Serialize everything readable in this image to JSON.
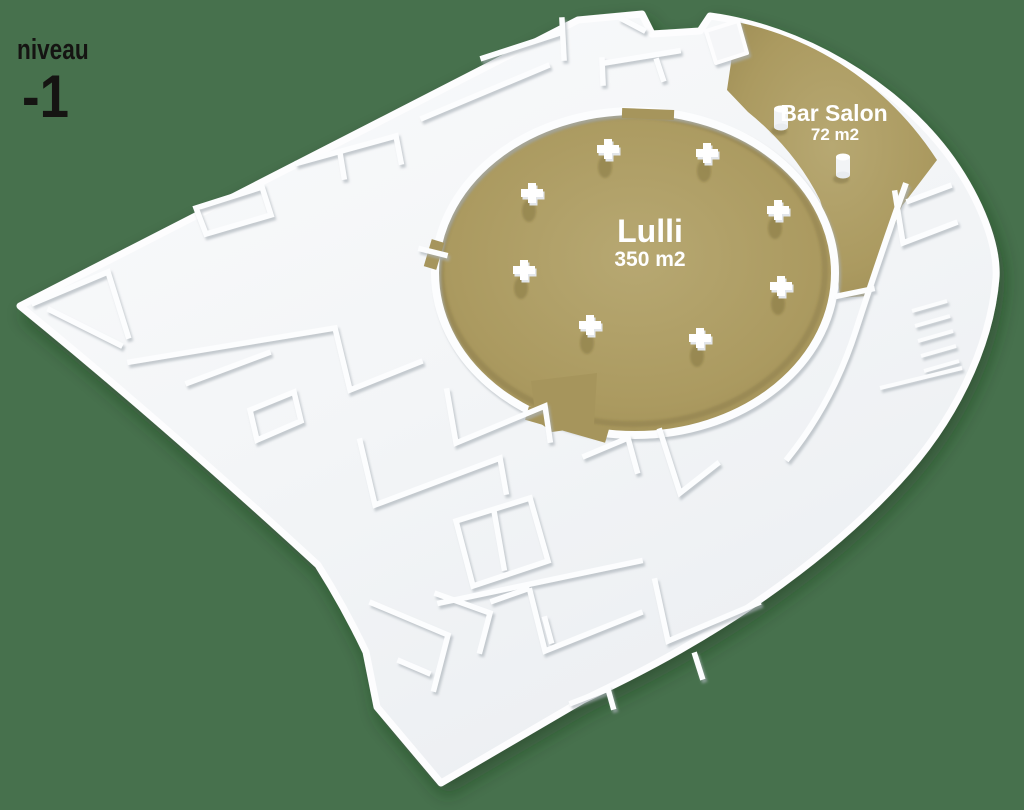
{
  "level_indicator": {
    "label": "niveau",
    "value": "-1"
  },
  "rooms": {
    "lulli": {
      "name": "Lulli",
      "area": "350 m2"
    },
    "bar_salon": {
      "name": "Bar Salon",
      "area": "72 m2"
    }
  },
  "colors": {
    "background": "#47714d",
    "highlight_gold": "#ab9a60",
    "walls_white": "#fbfcfd",
    "label_light": "#ffffff",
    "label_dark": "#151412"
  }
}
